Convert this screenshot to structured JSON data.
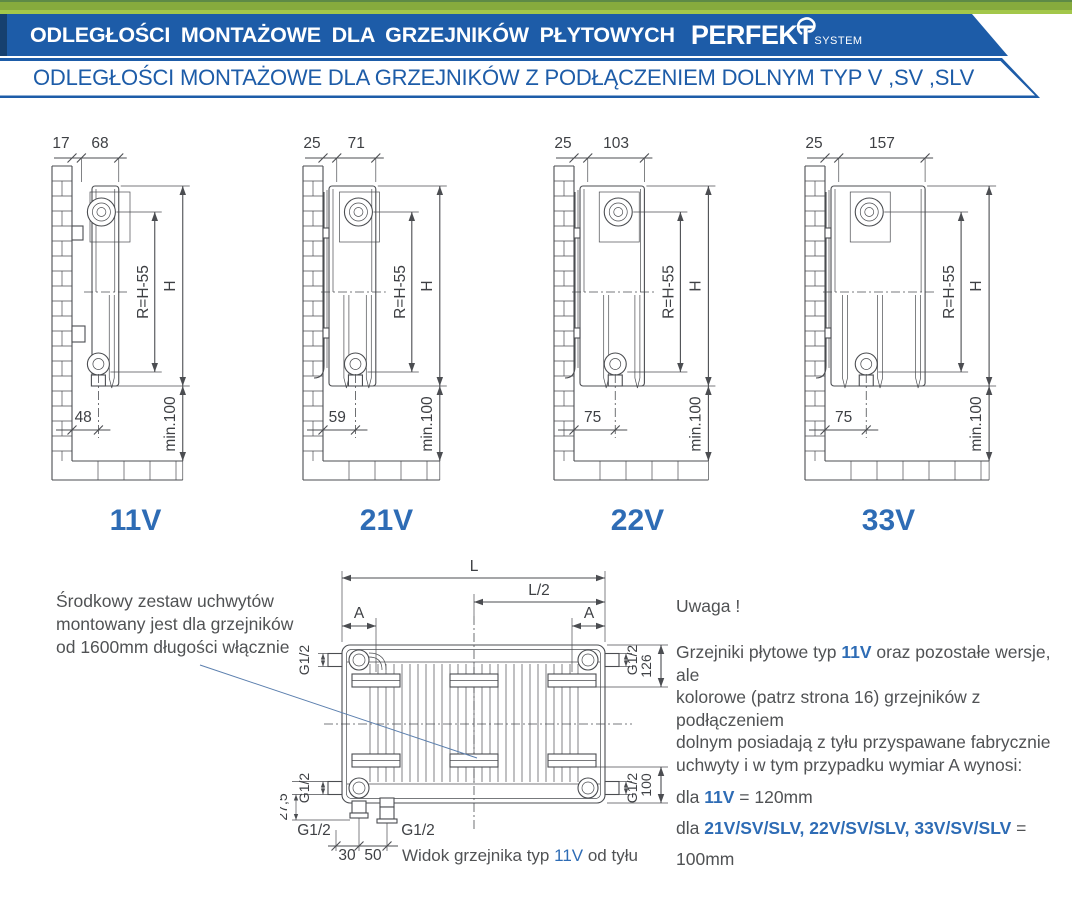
{
  "colors": {
    "accent": "#2e6cb5",
    "banner_blue": "#1d5ca8",
    "green_bar": "#86ab3d",
    "line": "#4b4d51"
  },
  "header": {
    "title": "ODLEGŁOŚCI MONTAŻOWE DLA GRZEJNIKÓW PŁYTOWYCH",
    "logo_main": "PERFEKT",
    "logo_sub": "SYSTEM",
    "subtitle": "ODLEGŁOŚCI MONTAŻOWE DLA GRZEJNIKÓW Z PODŁĄCZENIEM DOLNYM TYP V ,SV ,SLV"
  },
  "side_diagrams": [
    {
      "label": "11V",
      "top_offset": "17",
      "top_width": "68",
      "bottom": "48",
      "r_label": "R=H-55",
      "h_label": "H",
      "min_label": "min.100",
      "offset_mm": 17,
      "width_mm": 68,
      "bottom_mm": 48,
      "pipes": 1
    },
    {
      "label": "21V",
      "top_offset": "25",
      "top_width": "71",
      "bottom": "59",
      "r_label": "R=H-55",
      "h_label": "H",
      "min_label": "min.100",
      "offset_mm": 25,
      "width_mm": 71,
      "bottom_mm": 59,
      "pipes": 2
    },
    {
      "label": "22V",
      "top_offset": "25",
      "top_width": "103",
      "bottom": "75",
      "r_label": "R=H-55",
      "h_label": "H",
      "min_label": "min.100",
      "offset_mm": 25,
      "width_mm": 103,
      "bottom_mm": 75,
      "pipes": 2
    },
    {
      "label": "33V",
      "top_offset": "25",
      "top_width": "157",
      "bottom": "75",
      "r_label": "R=H-55",
      "h_label": "H",
      "min_label": "min.100",
      "offset_mm": 25,
      "width_mm": 157,
      "bottom_mm": 75,
      "pipes": 3
    }
  ],
  "rear_view": {
    "labels": {
      "L": "L",
      "half": "L/2",
      "A": "A",
      "g": "G1/2",
      "d126": "126",
      "d100": "100",
      "d275": "27,5",
      "d30": "30",
      "d50": "50"
    },
    "caption": [
      {
        "t": "Widok grzejnika typ "
      },
      {
        "t": "11V",
        "b": true
      },
      {
        "t": " od tyłu"
      }
    ]
  },
  "left_note": {
    "text": "Środkowy zestaw uchwytów\nmontowany jest dla grzejników\nod 1600mm długości włącznie"
  },
  "right_note": {
    "heading": "Uwaga !",
    "para": [
      {
        "t": "Grzejniki płytowe typ "
      },
      {
        "t": "11V",
        "b": true
      },
      {
        "t": " oraz pozostałe wersje, ale\nkolorowe (patrz strona 16) grzejników z podłączeniem\ndolnym posiadają z tyłu przyspawane fabrycznie\nuchwyty i w tym przypadku wymiar A wynosi:"
      }
    ],
    "line1": [
      {
        "t": "dla "
      },
      {
        "t": "11V",
        "b": true
      },
      {
        "t": " = 120mm"
      }
    ],
    "line2": [
      {
        "t": "dla "
      },
      {
        "t": "21V/SV/SLV, 22V/SV/SLV, 33V/SV/SLV",
        "b": true
      },
      {
        "t": " = 100mm"
      }
    ]
  }
}
